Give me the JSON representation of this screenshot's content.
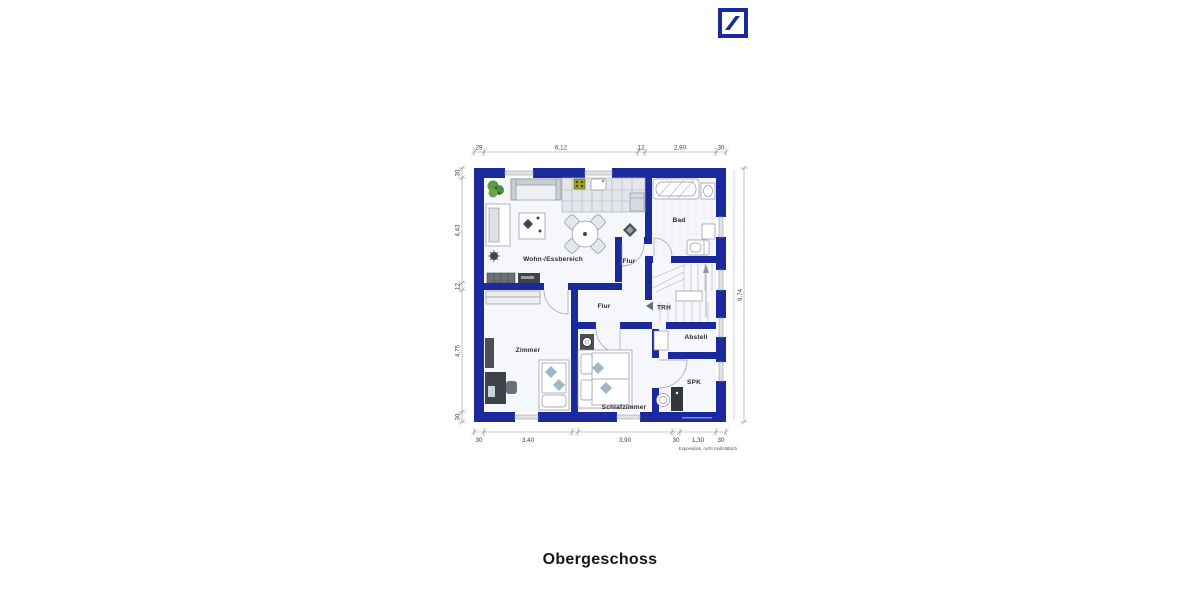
{
  "floorplan": {
    "caption": "Obergeschoss",
    "note": "Exposéplan, nicht maßstäblich",
    "rooms": {
      "living": "Wohn-/Essbereich",
      "bath": "Bad",
      "hall_upper": "Flur",
      "hall_lower": "Flur",
      "staircase": "TRH",
      "storage": "Abstell",
      "pantry": "SPK",
      "room": "Zimmer",
      "bedroom": "Schlafzimmer"
    },
    "dimensions": {
      "top": [
        "29",
        "6,12",
        "12",
        "2,90",
        "30"
      ],
      "left": [
        "30",
        "4,43",
        "12",
        "4,75",
        "30"
      ],
      "right": [
        "9,74"
      ],
      "bottom": [
        "30",
        "3,40",
        "3,90",
        "30",
        "1,30",
        "30"
      ]
    },
    "colors": {
      "wall": "#1A2A9C",
      "logo": "#1A2A9C",
      "floor": "#F6F7FA"
    }
  }
}
